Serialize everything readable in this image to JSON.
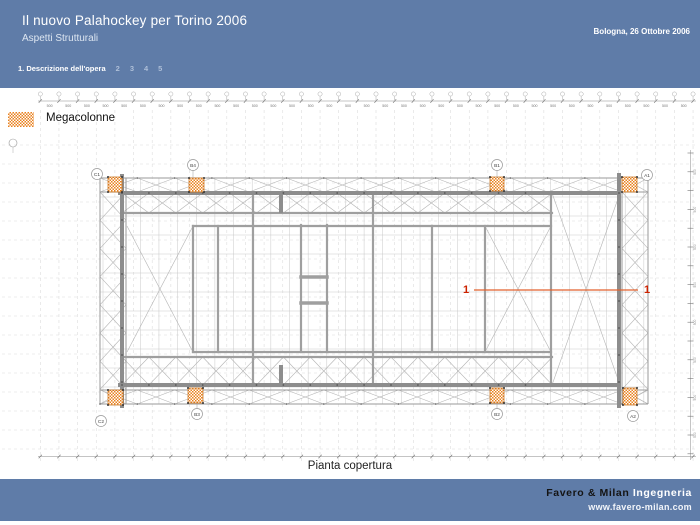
{
  "header": {
    "title": "Il nuovo Palahockey per Torino 2006",
    "subtitle": "Aspetti Strutturali",
    "date": "Bologna, 26 Ottobre 2006",
    "nav": {
      "active": "1. Descrizione dell'opera",
      "items": [
        "2",
        "3",
        "4",
        "5"
      ]
    }
  },
  "legend": {
    "label": "Megacolonne",
    "swatch_color": "#e8811f"
  },
  "drawing": {
    "caption": "Pianta copertura",
    "dim_label": "500",
    "section_label": "1",
    "grid_labels_top": [
      "C1",
      "B4",
      "B1",
      "A1"
    ],
    "grid_labels_bottom": [
      "C2",
      "B3",
      "B2",
      "A2"
    ]
  },
  "footer": {
    "company": "Favero & Milan",
    "company_suffix": "Ingegneria",
    "website": "www.favero-milan.com"
  },
  "colors": {
    "band_blue": "#5f7ca8",
    "column_orange": "#e8811f",
    "section_red": "#cc2200",
    "structure_gray": "#9a9a9a"
  }
}
